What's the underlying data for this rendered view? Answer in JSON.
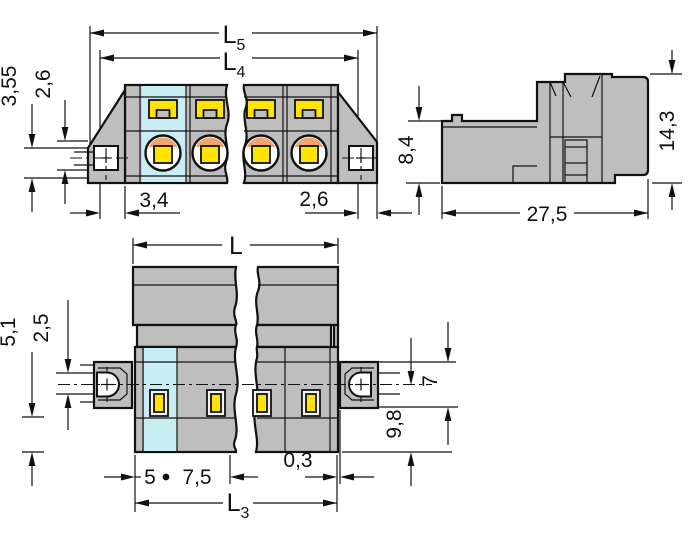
{
  "drawing": {
    "type": "connector-dimensional-drawing",
    "colors": {
      "body_gray": "#BEBEBE",
      "highlight_cyan": "#C8EDF2",
      "contact_yellow": "#FFE400",
      "clamp_orange": "#F2A470",
      "line_black": "#111111",
      "background": "#FFFFFF"
    },
    "front_view": {
      "dim_l5": {
        "main": "L",
        "sub": "5"
      },
      "dim_l4": {
        "main": "L",
        "sub": "4"
      },
      "dim_355": "3,55",
      "dim_26_left": "2,6",
      "dim_34": "3,4",
      "dim_26_right": "2,6"
    },
    "side_view": {
      "dim_84": "8,4",
      "dim_143": "14,3",
      "dim_275": "27,5"
    },
    "plan_view": {
      "dim_l": "L",
      "dim_25": "2,5",
      "dim_51": "5,1",
      "dim_7": "7",
      "dim_98": "9,8",
      "dim_5": "5",
      "dim_75": "7,5",
      "dim_03": "0,3",
      "dim_l3": {
        "main": "L",
        "sub": "3"
      }
    }
  }
}
